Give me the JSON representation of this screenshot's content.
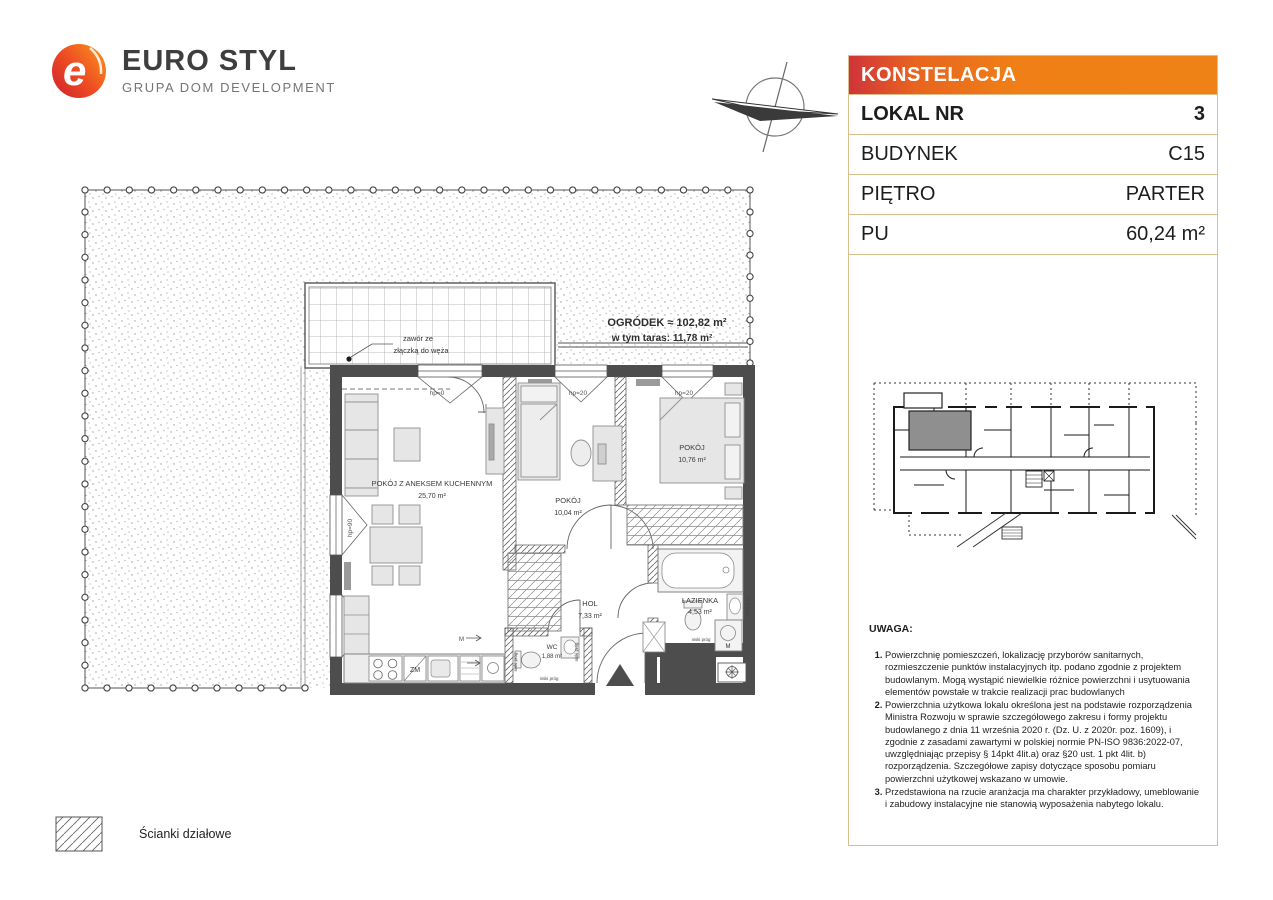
{
  "logo": {
    "brand": "EURO STYL",
    "subtitle": "GRUPA DOM DEVELOPMENT"
  },
  "panel": {
    "project": "KONSTELACJA",
    "rows": [
      {
        "label": "LOKAL NR",
        "value": "3"
      },
      {
        "label": "BUDYNEK",
        "value": "C15"
      },
      {
        "label": "PIĘTRO",
        "value": "PARTER"
      },
      {
        "label": "PU",
        "value": "60,24 m²"
      }
    ]
  },
  "plan": {
    "garden": {
      "title": "OGRÓDEK ≈ 102,82 m²",
      "subtitle": "w tym taras: 11,78 m²"
    },
    "valve": {
      "line1": "zawór ze",
      "line2": "złączką do węża"
    },
    "rooms": [
      {
        "name": "POKÓJ Z ANEKSEM KUCHENNYM",
        "area": "25,70 m²"
      },
      {
        "name": "POKÓJ",
        "area": "10,04 m²"
      },
      {
        "name": "POKÓJ",
        "area": "10,76 m²"
      },
      {
        "name": "HOL",
        "area": "7,33 m²"
      },
      {
        "name": "ŁAZIENKA",
        "area": "4,53 m²"
      },
      {
        "name": "WC",
        "area": "1,88 m²"
      }
    ],
    "windows": [
      "hp=0",
      "hp=20",
      "hp=20",
      "hp=90",
      "hp=90"
    ],
    "threshold": "niski próg",
    "appliances": {
      "dishwasher": "ZM",
      "washer": "M"
    }
  },
  "notes": {
    "title": "UWAGA:",
    "items": [
      "Powierzchnię pomieszczeń, lokalizację przyborów sanitarnych, rozmieszczenie punktów instalacyjnych itp. podano zgodnie z projektem budowlanym. Mogą wystąpić niewielkie różnice powierzchni i usytuowania elementów powstałe w trakcie realizacji prac budowlanych",
      "Powierzchnia użytkowa lokalu określona jest na podstawie rozporządzenia Ministra Rozwoju w sprawie szczegółowego zakresu i formy projektu budowlanego z dnia 11 września 2020 r. (Dz. U. z 2020r. poz. 1609), i zgodnie z zasadami zawartymi w polskiej normie PN-ISO 9836:2022-07, uwzględniając przepisy § 14pkt 4lit.a) oraz §20 ust. 1 pkt 4lit. b) rozporządzenia. Szczegółowe zapisy dotyczące sposobu pomiaru powierzchni użytkowej wskazano w umowie.",
      "Przedstawiona na rzucie aranżacja ma charakter przykładowy, umeblowanie i zabudowy instalacyjne nie stanowią wyposażenia nabytego lokalu."
    ]
  },
  "legend": {
    "partition_walls": "Ścianki działowe"
  },
  "colors": {
    "banner_left": "#cf3439",
    "banner_right": "#ef8217",
    "panel_border": "#dcbe8c",
    "wall": "#4d4d4d",
    "highlight_unit": "#8f8f8f"
  }
}
